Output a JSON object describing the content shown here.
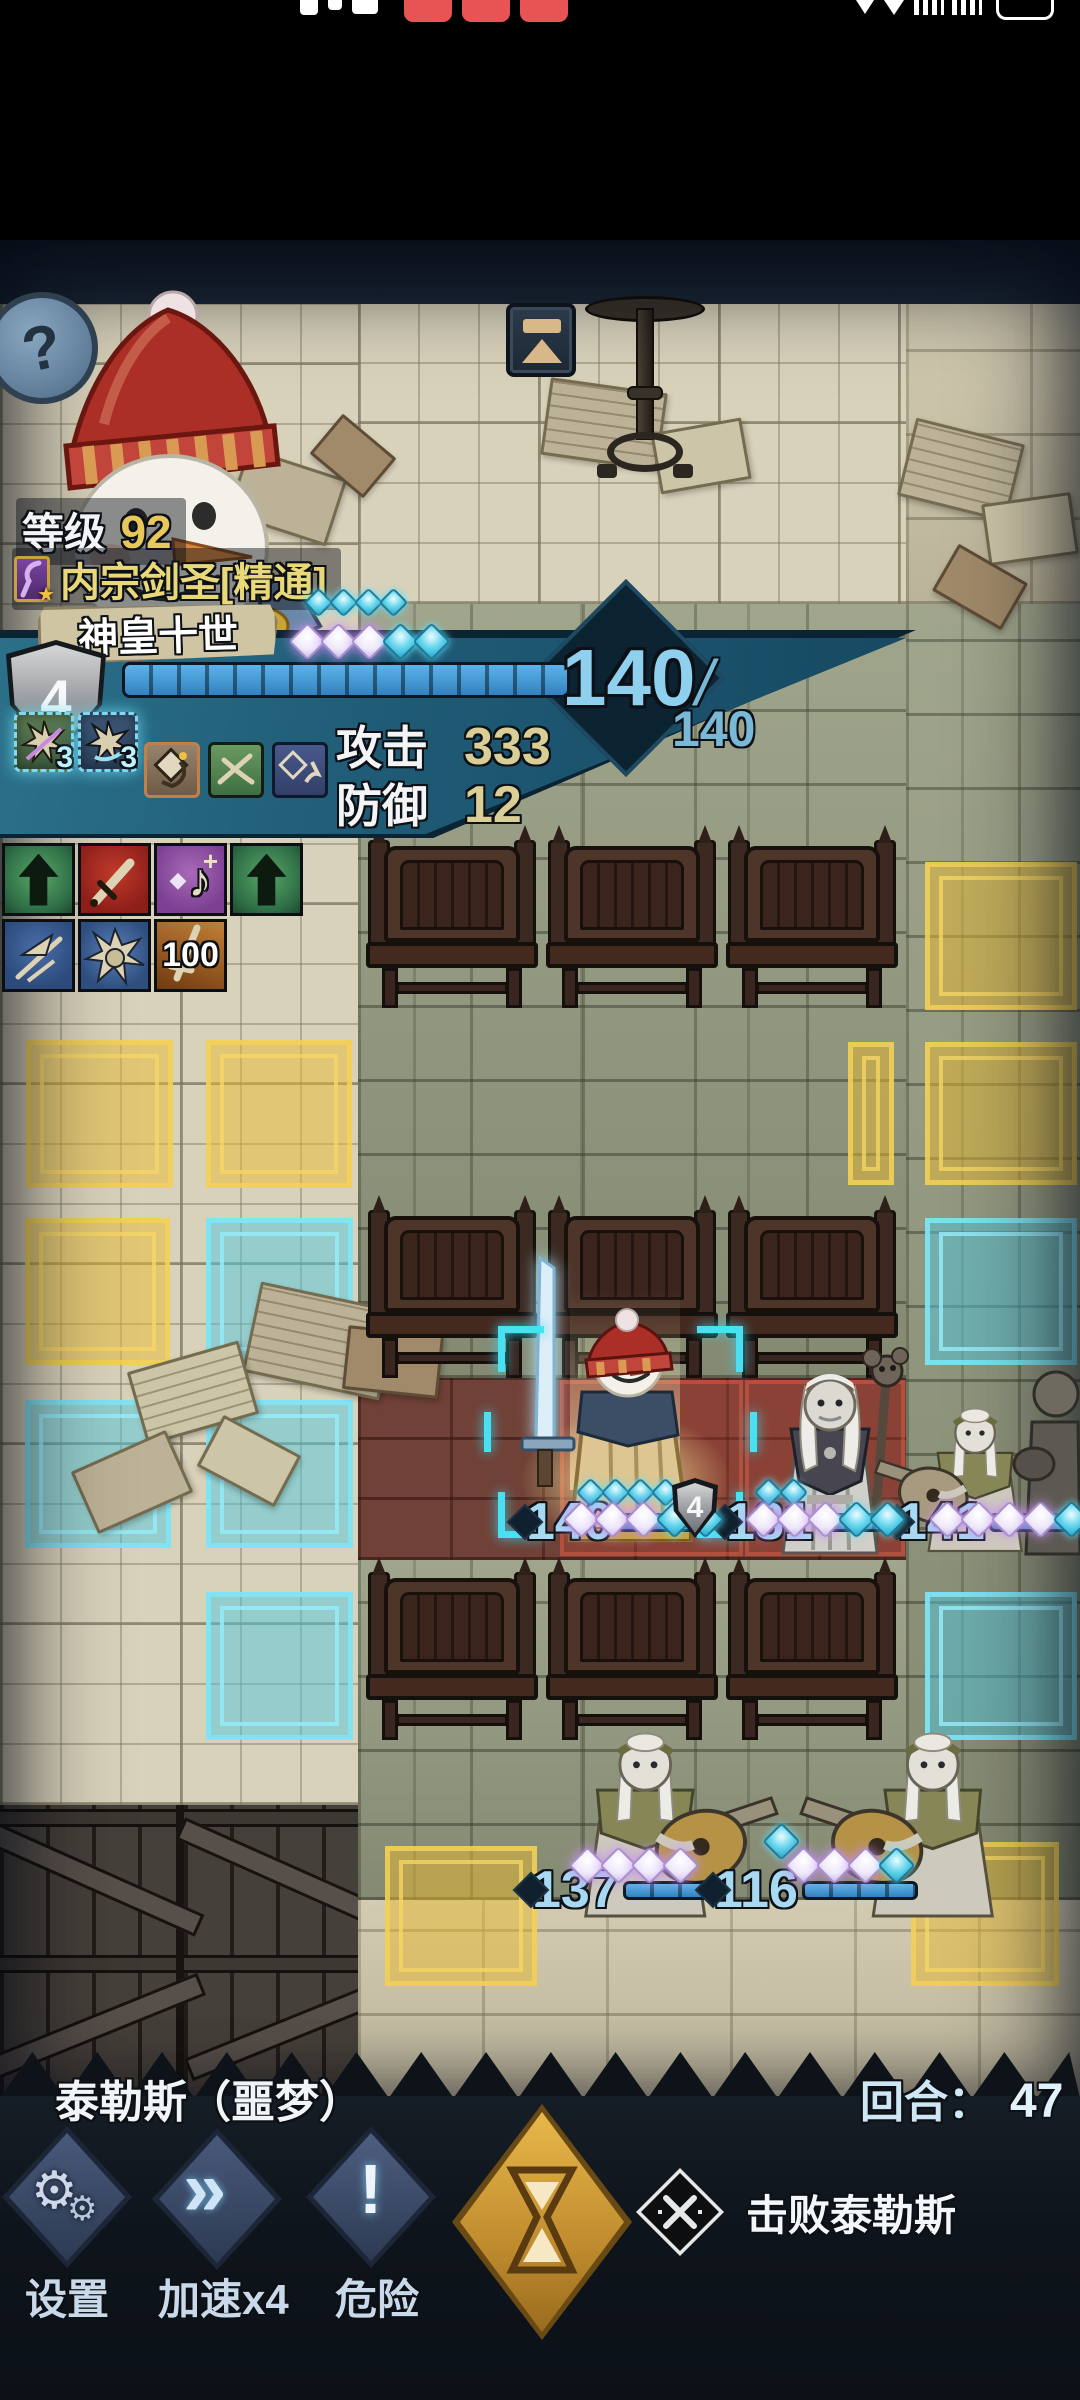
{
  "icons": {
    "help": "?",
    "gear_large": "⚙",
    "gear_small": "⚙",
    "speed_chevrons": "»",
    "danger_mark": "!",
    "class_star": "★",
    "music_note": "♪",
    "music_gem": "◆",
    "music_plus": "+"
  },
  "hud": {
    "level_label": "等级",
    "level_value": "92",
    "class_name": "内宗剑圣[精通]",
    "character_name": "神皇十世",
    "block_value": "4",
    "hp_current": "140",
    "hp_slash": "/",
    "hp_max": "140",
    "attack_label": "攻击",
    "attack_value": "333",
    "defense_label": "防御",
    "defense_value": "12",
    "skill_charges": [
      "3",
      "3"
    ],
    "buff_value_100": "100"
  },
  "units": {
    "player": {
      "hp": "140",
      "block": "4",
      "gems_top": "cccc",
      "gems_bottom": "wwwcc"
    },
    "priest": {
      "hp": "181",
      "gems_top": "cc",
      "gems_bottom": "wwwcc"
    },
    "bard_right": {
      "hp": "141",
      "gems_bottom": "wwwwc"
    },
    "bard_bottom_left": {
      "hp": "137",
      "gems_bottom": "wwww"
    },
    "bard_bottom_right": {
      "hp": "116",
      "gems_bottom": "wwwc",
      "gem_extra": "c"
    }
  },
  "bottom": {
    "location": "泰勒斯（噩梦）",
    "round_label": "回合：",
    "round_value": "47",
    "settings_label": "设置",
    "speed_label": "加速x4",
    "danger_label": "危险",
    "objective_text": "击败泰勒斯"
  }
}
